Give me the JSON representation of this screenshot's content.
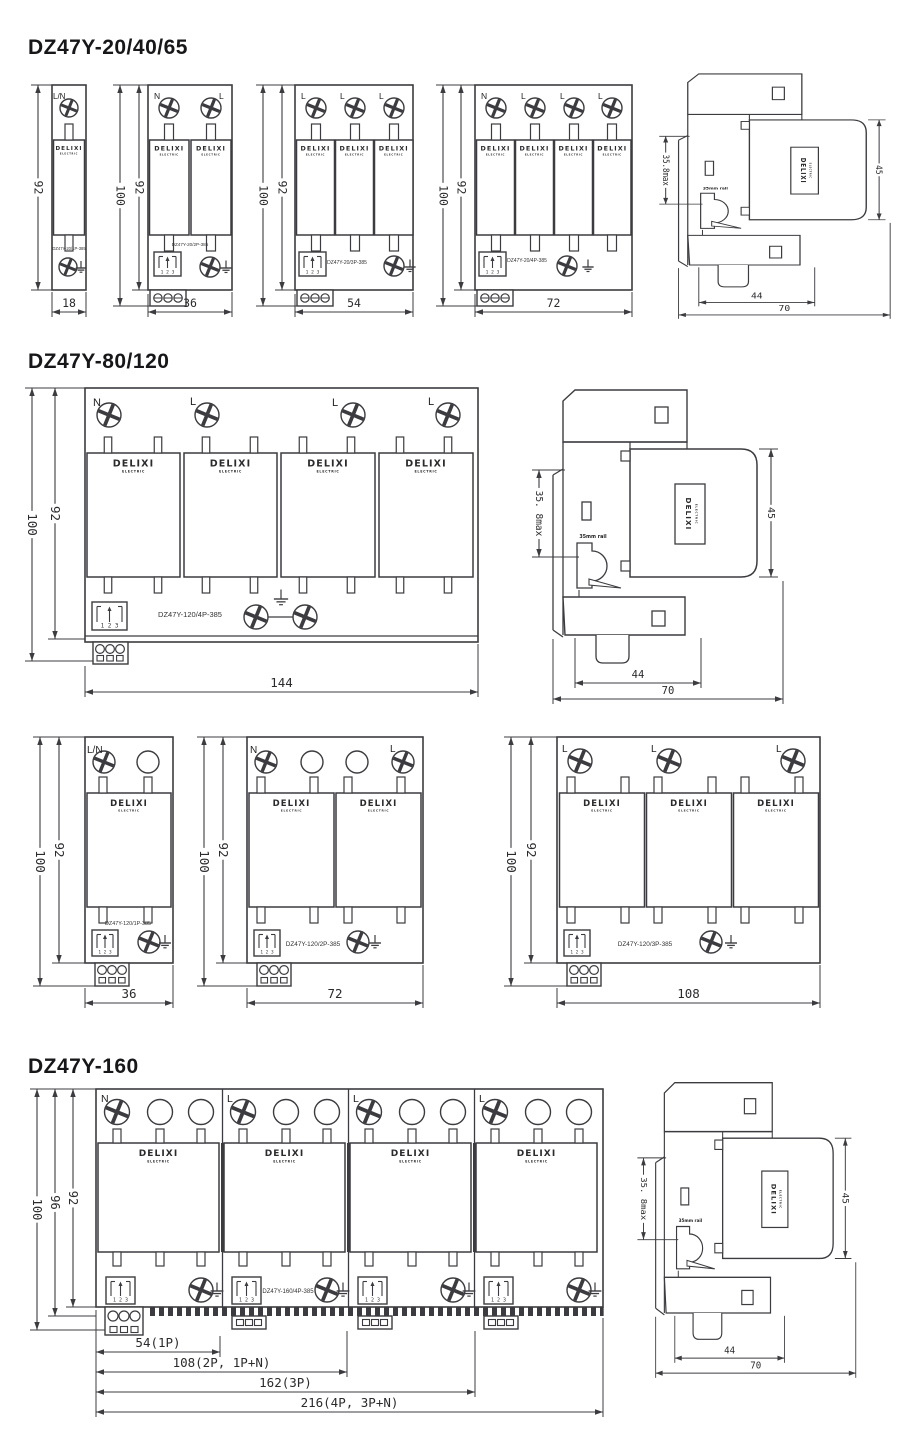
{
  "sections": {
    "s1": {
      "title": "DZ47Y-20/40/65"
    },
    "s2": {
      "title": "DZ47Y-80/120"
    },
    "s3": {
      "title": "DZ47Y-160"
    }
  },
  "brand": {
    "name": "DELIXI",
    "sub": "ELECTRIC"
  },
  "counter": {
    "digits": "1 2 3"
  },
  "notes": {
    "rail_note": "35mm rail",
    "pull_note": "Pull down"
  },
  "units": {
    "s1u1": {
      "model": "DZ47Y-20/1P-385",
      "terminals": [
        "L/N"
      ],
      "height_dim": "92",
      "width_dim": "18"
    },
    "s1u2": {
      "model": "DZ47Y-20/2P-385",
      "terminals": [
        "N",
        "L"
      ],
      "outer_dim": "100",
      "height_dim": "92",
      "width_dim": "36"
    },
    "s1u3": {
      "model": "DZ47Y-20/3P-385",
      "terminals": [
        "L",
        "L",
        "L"
      ],
      "outer_dim": "100",
      "height_dim": "92",
      "width_dim": "54"
    },
    "s1u4": {
      "model": "DZ47Y-20/4P-385",
      "terminals": [
        "N",
        "L",
        "L",
        "L"
      ],
      "outer_dim": "100",
      "height_dim": "92",
      "width_dim": "72"
    },
    "s2u4": {
      "model": "DZ47Y-120/4P-385",
      "terminals": [
        "N",
        "L",
        "L",
        "L"
      ],
      "outer_dim": "100",
      "height_dim": "92",
      "width_dim": "144"
    },
    "s2u1": {
      "model": "DZ47Y-120/1P-385",
      "terminals": [
        "L/N"
      ],
      "outer_dim": "100",
      "height_dim": "92",
      "width_dim": "36"
    },
    "s2u2": {
      "model": "DZ47Y-120/2P-385",
      "terminals": [
        "N",
        "L"
      ],
      "outer_dim": "100",
      "height_dim": "92",
      "width_dim": "72"
    },
    "s2u3": {
      "model": "DZ47Y-120/3P-385",
      "terminals": [
        "L",
        "L",
        "L"
      ],
      "outer_dim": "100",
      "height_dim": "92",
      "width_dim": "108"
    },
    "s3u4": {
      "model": "DZ47Y-160/4P-385",
      "terminals": [
        "N",
        "L",
        "L",
        "L"
      ],
      "height_dims": [
        "100",
        "96",
        "92"
      ],
      "width_dims": [
        "54(1P)",
        "108(2P, 1P+N)",
        "162(3P)",
        "216(4P, 3P+N)"
      ]
    }
  },
  "side_views": {
    "s1": {
      "height_dim": "35.8max",
      "body_dim": "45",
      "depth_dim": "44",
      "total_dim": "70"
    },
    "s2": {
      "height_dim": "35. 8max",
      "body_dim": "45",
      "depth_dim": "44",
      "total_dim": "70"
    },
    "s3": {
      "height_dim": "35. 8max",
      "body_dim": "45",
      "depth_dim": "44",
      "total_dim": "70"
    }
  },
  "colors": {
    "line": "#3c3c40",
    "text": "#26262a",
    "title": "#17171a",
    "background": "#ffffff"
  }
}
